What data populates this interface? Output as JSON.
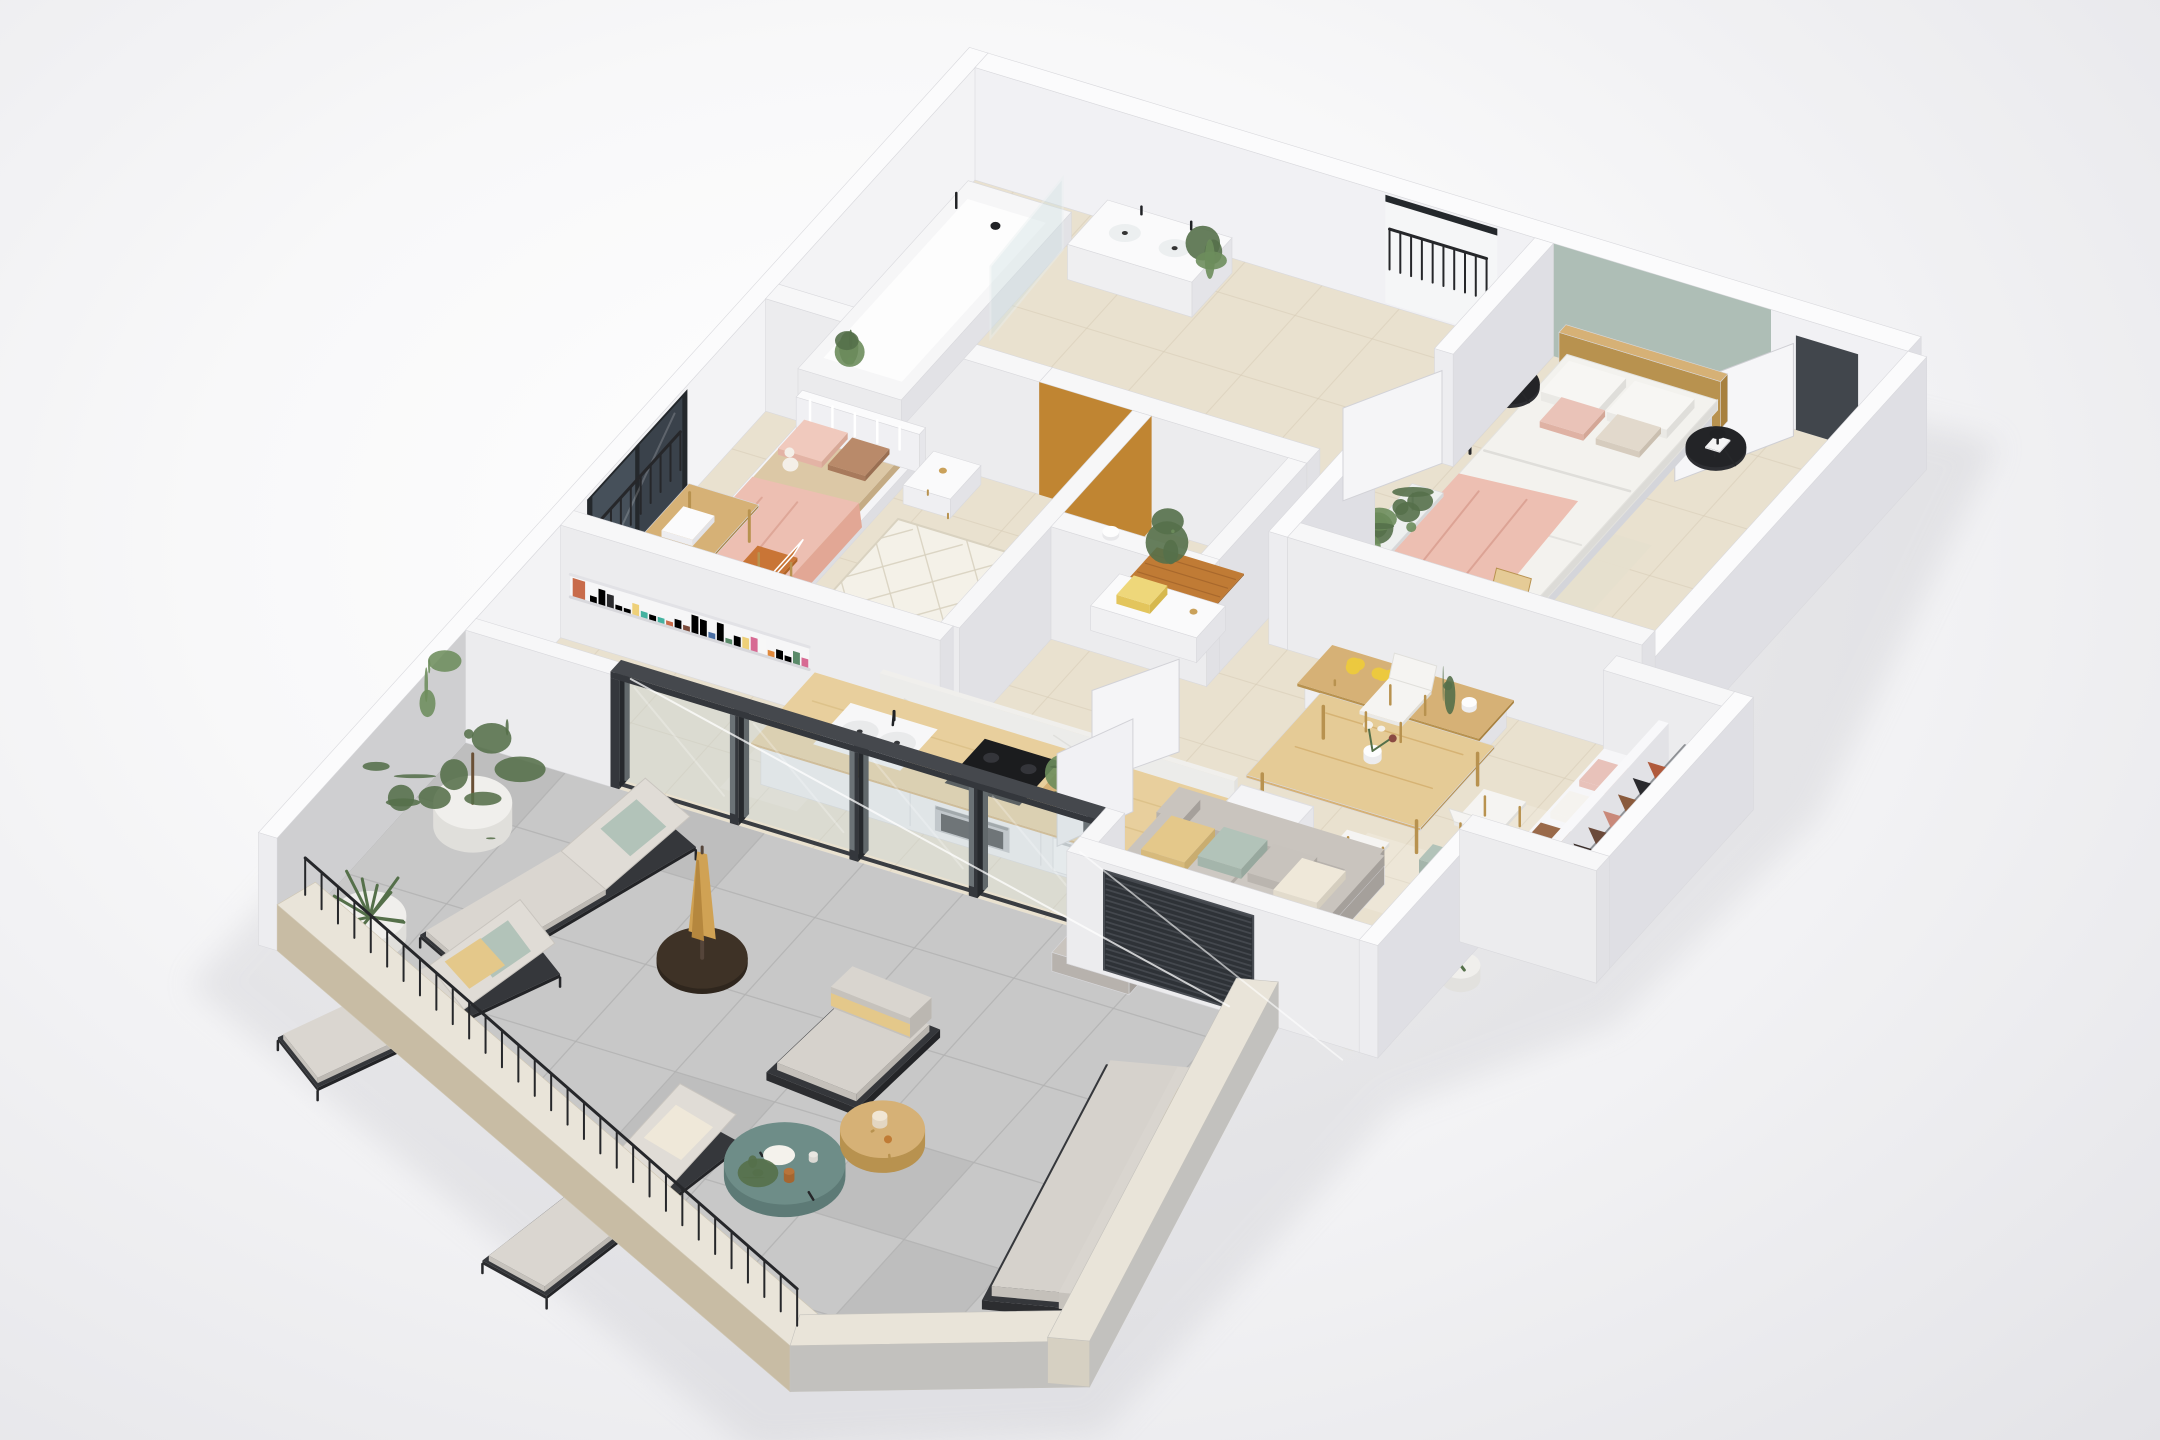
{
  "scene": {
    "type": "isometric-3d-floor-plan-render",
    "style": "photorealistic apartment cutaway model, no text labels",
    "rooms": [
      {
        "name": "kids-bedroom",
        "furniture": [
          "white-metal-single-bed",
          "beige-bedding",
          "pink-throw-blanket",
          "teddy-bear",
          "lattice-pattern-rug",
          "wooden-desk",
          "terracotta-chair",
          "white-chair",
          "white-nightstand",
          "white-dresser",
          "tissue-box",
          "floor-to-ceiling-window",
          "window-guard-railing"
        ]
      },
      {
        "name": "bathroom",
        "furniture": [
          "bathtub",
          "glass-shower-screen",
          "double-basin-vanity",
          "black-taps",
          "potted-plants"
        ]
      },
      {
        "name": "toilet-room",
        "furniture": [
          "toilet-paper-holder",
          "wooden-floor-mat",
          "white-cabinet",
          "storage-box",
          "mustard-accent-wall"
        ]
      },
      {
        "name": "hallway",
        "furniture": [
          "juliet-balcony-black-railing",
          "open-white-doors"
        ]
      },
      {
        "name": "master-bedroom",
        "furniture": [
          "double-bed",
          "wooden-headboard",
          "white-duvet",
          "pink-throw-blanket",
          "pillows",
          "black-round-nightstands",
          "black-table-lamp",
          "black-floor-lamp",
          "plant-bench",
          "wooden-desk",
          "wooden-chair",
          "beige-rug",
          "sage-accent-wall"
        ]
      },
      {
        "name": "entrance",
        "furniture": [
          "front-door-white",
          "lever-handle"
        ]
      },
      {
        "name": "kitchen",
        "furniture": [
          "counter-with-oak-worktop",
          "double-sink",
          "black-tap",
          "induction-cooktop",
          "built-in-oven",
          "washing-machine",
          "fridge",
          "book-shelf-colorful-spines",
          "marble-splashback",
          "herb-crate",
          "glass-sliding-doors"
        ]
      },
      {
        "name": "dining-area",
        "furniture": [
          "oak-dining-table",
          "white-shell-chairs",
          "flower-vase",
          "wooden-sideboard",
          "yellow-bouquet"
        ]
      },
      {
        "name": "living-room",
        "furniture": [
          "gray-chaise-sofa",
          "scatter-cushions",
          "sage-armchair",
          "oak-coffee-table",
          "diamond-pattern-rug",
          "white-floor-vase",
          "snake-plant",
          "dark-slatted-window"
        ]
      },
      {
        "name": "walk-in-wardrobe",
        "furniture": [
          "hanging-clothes-rod",
          "folded-clothes-shelves",
          "white-partition"
        ]
      },
      {
        "name": "terrace",
        "furniture": [
          "three-sun-loungers",
          "closed-tan-parasol",
          "round-parasol-base",
          "outdoor-armchair",
          "outdoor-sofa",
          "round-side-table-wood",
          "round-coffee-table-teal",
          "potted-tree",
          "zz-plant-pot",
          "black-metal-railing",
          "concrete-parapet"
        ]
      }
    ]
  },
  "palette": {
    "bg_center": "#ffffff",
    "bg_edge": "#e6e6ea",
    "shadow": "#b9b9c0",
    "wall_top": "#fbfbfc",
    "wall_south": "#ededf0",
    "wall_east": "#dfdfe4",
    "wall_inner_bright": "#f3f3f5",
    "concrete_inner": "#cfcfd1",
    "parapet_outer_west": "#c8bca4",
    "parapet_outer_east": "#c2c1be",
    "parapet_top": "#e9e4d9",
    "parapet_cap": "#d6d0c2",
    "floor": "#e9e1cf",
    "tile_line": "#d7ccb7",
    "terrace_floor": "#c8c8c8",
    "terrace_line": "#b2b2b2",
    "terrace_dark_tile": "#bbbbbb",
    "mustard": "#c08532",
    "sage": "#aebeb6",
    "wood": "#d6b176",
    "wood_dark": "#b8924f",
    "wood_pale": "#e5cb96",
    "orange_chair": "#c97536",
    "pink": "#edbfb2",
    "pink_deep": "#e2a795",
    "bedding_beige": "#dcc8a6",
    "duvet": "#f3f2ee",
    "black": "#26272a",
    "metal_dark": "#35373b",
    "steel": "#bfc1c5",
    "glass": "#c5d2d6",
    "window_glass": "#3a424b",
    "window_frame": "#24282c",
    "sofa": "#b7b2ad",
    "sofa_light": "#c9c4be",
    "cushion_yellow": "#e4c88a",
    "cushion_sage": "#b2c3b9",
    "cushion_cream": "#efe8d9",
    "rug": "#f4f1e8",
    "rug_line": "#d9d2c0",
    "teal_table": "#6e8d88",
    "umbrella": "#d0a254",
    "umbrella_dark": "#b5873e",
    "fridge": "#f4f4f6",
    "white_furniture": "#f2f2f3",
    "green": "#6d8d5c",
    "green_dark": "#55704a",
    "pot_white": "#f0efec",
    "marble": "#f0efec",
    "books": [
      "#2b2b2e",
      "#c94a4e",
      "#e0893c",
      "#e7b2c8",
      "#9a6ab4",
      "#44b2a0",
      "#efe8e1",
      "#4a6fa4",
      "#c86b4a",
      "#eed079",
      "#7a4a3a",
      "#f7f7f7",
      "#d76a93",
      "#5a8a69"
    ],
    "clothes_hanging": [
      "#b05a3c",
      "#2a2a2e",
      "#8a5a3c",
      "#c9897a",
      "#6b4a3a",
      "#3a2e2a"
    ],
    "clothes_folded": [
      "#e8c2ba",
      "#f5f3ef",
      "#9a6a4a",
      "#d89a90"
    ]
  }
}
